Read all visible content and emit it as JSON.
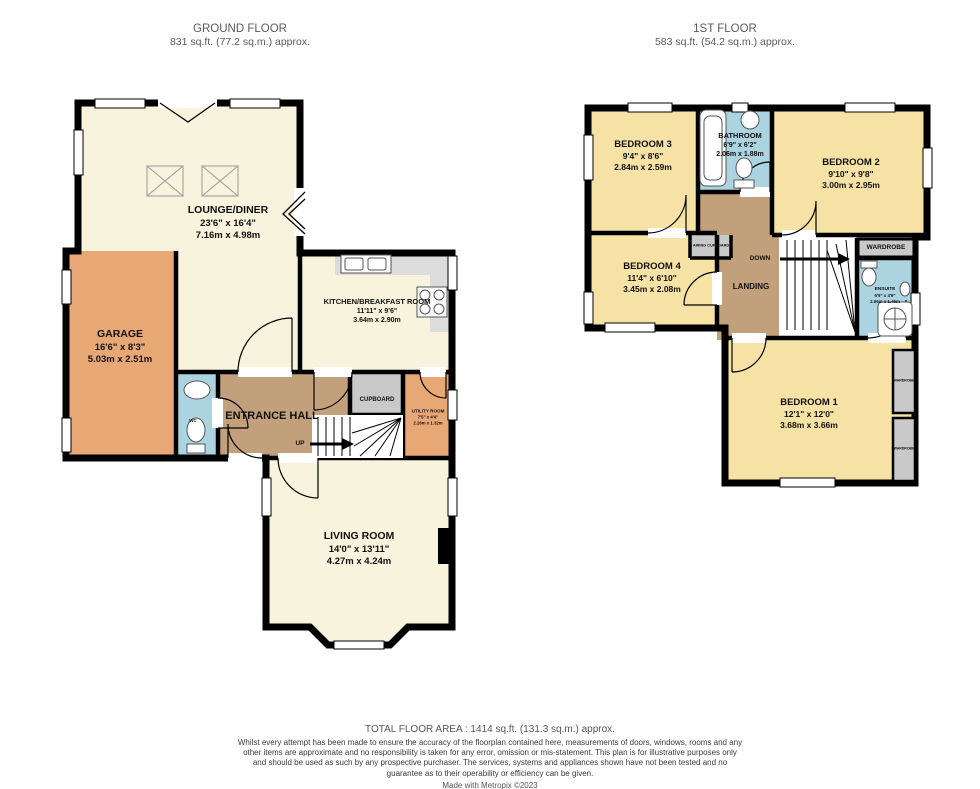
{
  "headers": {
    "ground": {
      "title": "GROUND FLOOR",
      "area": "831 sq.ft. (77.2 sq.m.) approx."
    },
    "first": {
      "title": "1ST FLOOR",
      "area": "583 sq.ft. (54.2 sq.m.) approx."
    }
  },
  "rooms": {
    "lounge": {
      "name": "LOUNGE/DINER",
      "imperial": "23'6\" x 16'4\"",
      "metric": "7.16m x 4.98m"
    },
    "garage": {
      "name": "GARAGE",
      "imperial": "16'6\" x 8'3\"",
      "metric": "5.03m x 2.51m"
    },
    "kitchen": {
      "name": "KITCHEN/BREAKFAST ROOM",
      "imperial": "11'11\" x 9'6\"",
      "metric": "3.64m x 2.90m"
    },
    "living": {
      "name": "LIVING ROOM",
      "imperial": "14'0\" x 13'11\"",
      "metric": "4.27m x 4.24m"
    },
    "utility": {
      "name": "UTILITY ROOM",
      "imperial": "7'5\" x 4'4\"",
      "metric": "2.26m x 1.32m"
    },
    "entrance_hall": {
      "name": "ENTRANCE HALL"
    },
    "cupboard": {
      "name": "CUPBOARD"
    },
    "wc": {
      "name": "WC"
    },
    "up_label": "UP",
    "bedroom1": {
      "name": "BEDROOM 1",
      "imperial": "12'1\" x 12'0\"",
      "metric": "3.68m x 3.66m"
    },
    "bedroom2": {
      "name": "BEDROOM 2",
      "imperial": "9'10\" x 9'8\"",
      "metric": "3.00m x 2.95m"
    },
    "bedroom3": {
      "name": "BEDROOM 3",
      "imperial": "9'4\" x 8'6\"",
      "metric": "2.84m x 2.59m"
    },
    "bedroom4": {
      "name": "BEDROOM 4",
      "imperial": "11'4\" x 6'10\"",
      "metric": "3.45m x 2.08m"
    },
    "bathroom": {
      "name": "BATHROOM",
      "imperial": "6'9\" x 6'2\"",
      "metric": "2.06m x 1.88m"
    },
    "ensuite": {
      "name": "ENSUITE",
      "imperial": "6'9\" x 4'9\"",
      "metric": "2.06m x 1.45m"
    },
    "landing": {
      "name": "LANDING"
    },
    "down_label": "DOWN",
    "airing_cupboard": {
      "name": "AIRING CUPBOARD"
    },
    "wardrobe": {
      "name": "WARDROBE"
    }
  },
  "footer": {
    "total": "TOTAL FLOOR AREA : 1414 sq.ft. (131.3 sq.m.) approx.",
    "disclaimer": "Whilst every attempt has been made to ensure the accuracy of the floorplan contained here, measurements of doors, windows, rooms and any other items are approximate and no responsibility is taken for any error, omission or mis-statement. This plan is for illustrative purposes only and should be used as such by any prospective purchaser. The services, systems and appliances shown have not been tested and no guarantee as to their operability or efficiency can be given.",
    "credit": "Made with Metropix ©2023"
  },
  "colors": {
    "floor_cream": "#F7F3DC",
    "floor_yellow": "#F5E2A4",
    "floor_orange": "#E8A876",
    "floor_tan": "#C2A07C",
    "floor_blue": "#ABD4E0",
    "storage_grey": "#C9C9C9",
    "counter_grey": "#DCDCDC",
    "wall": "#000000",
    "label_text": "#111111",
    "header_text": "#5a5a5a"
  }
}
